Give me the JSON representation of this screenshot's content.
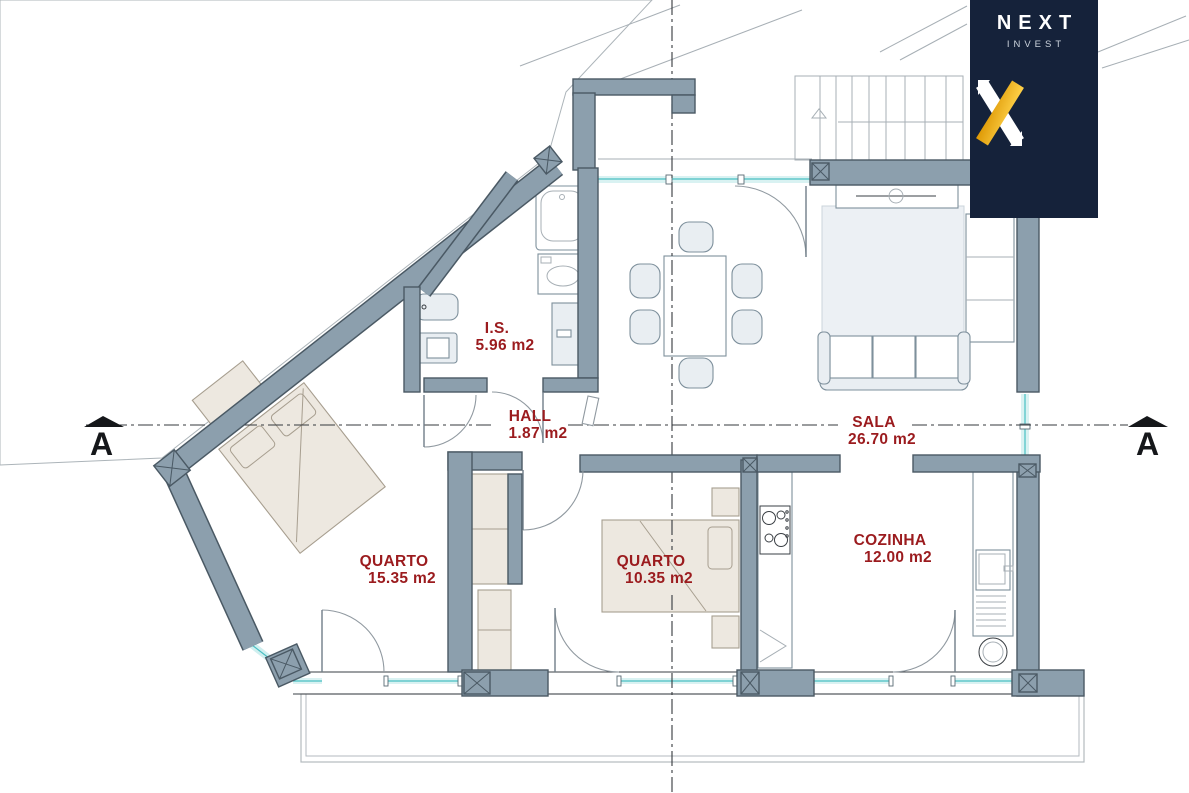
{
  "brand": {
    "name": "NEXT",
    "subtitle": "INVEST"
  },
  "rooms": [
    {
      "name": "I.S.",
      "area": "5.96 m2"
    },
    {
      "name": "HALL",
      "area": "1.87 m2"
    },
    {
      "name": "SALA",
      "area": "26.70 m2"
    },
    {
      "name": "QUARTO",
      "area": "15.35 m2"
    },
    {
      "name": "QUARTO",
      "area": "10.35 m2"
    },
    {
      "name": "COZINHA",
      "area": "12.00 m2"
    }
  ],
  "section_markers": {
    "left": "A",
    "right": "A"
  },
  "colors": {
    "wall": "#8C9FAD",
    "wall-edge": "#4A5964",
    "label": "#9B1B1E",
    "window": "#49BFC3",
    "window-fill": "#D9F2F2",
    "logo-bg": "#15223A",
    "logo-accent": "#F1AC15",
    "furniture": "#E9EEF2",
    "furniture-edge": "#7E909C",
    "wood": "#EDE8E0",
    "wood-edge": "#A79E8F",
    "line": "#3A3F44",
    "thin": "#A7AFB5"
  }
}
